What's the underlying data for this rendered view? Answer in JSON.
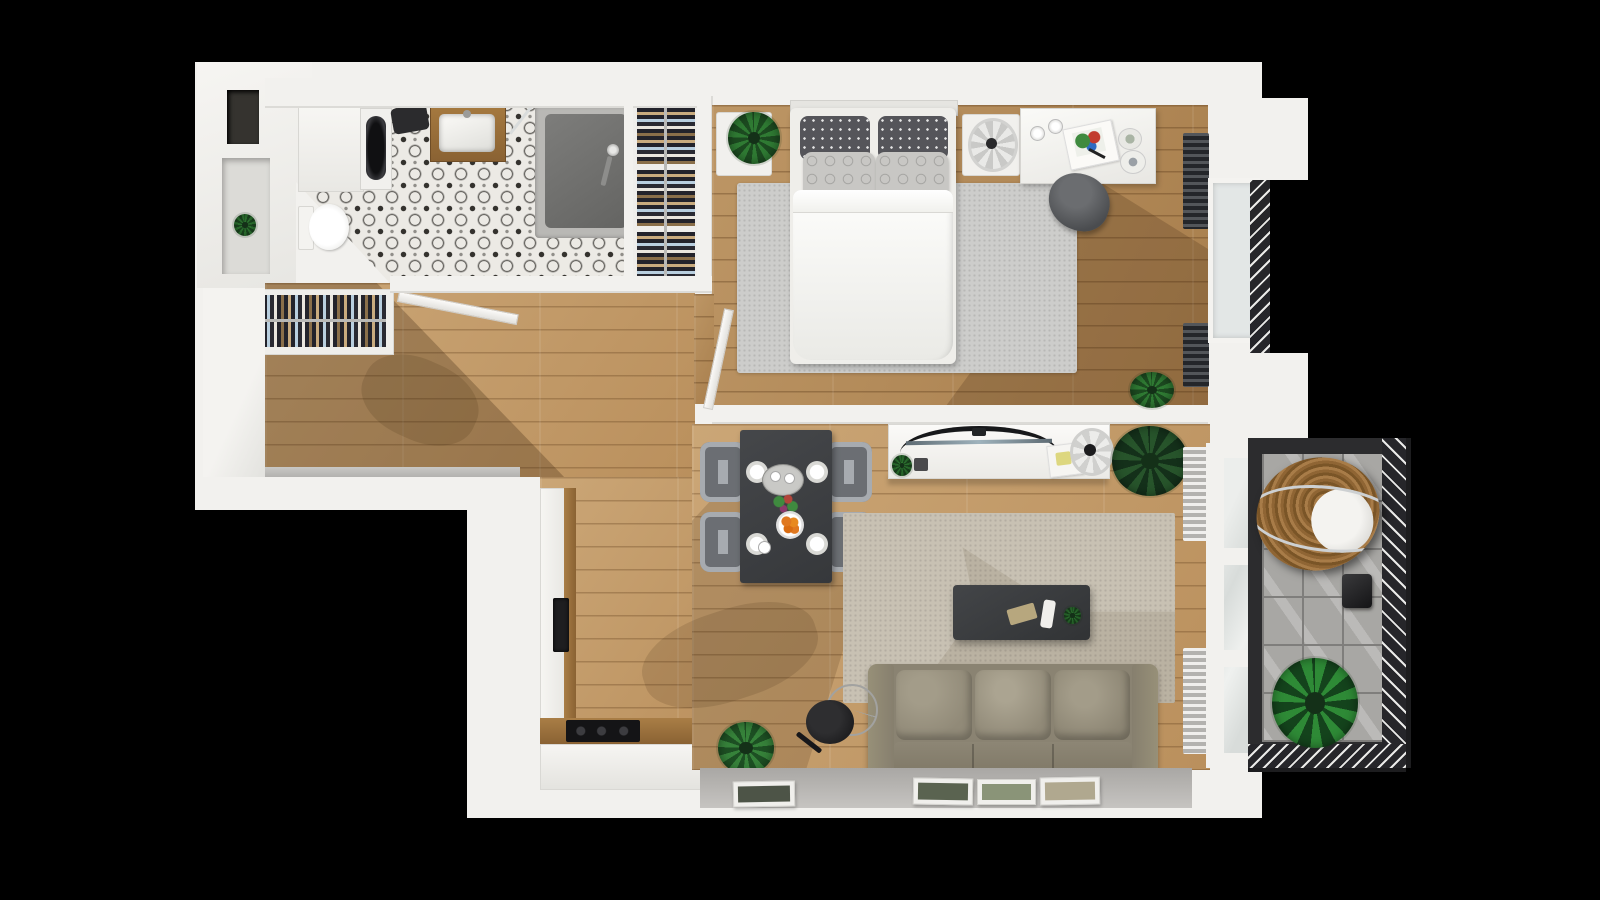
{
  "meta": {
    "title": "3D Apartment Floor Plan - Top View Render",
    "scene": "top-down 3D rendered floor plan of a one-bedroom apartment on a black background",
    "lighting": "sunlight casting diagonal shadows across wood floors"
  },
  "palette": {
    "bg": "#000000",
    "wall": "#f2f1ee",
    "walledge": "#d9d8d4",
    "wood": "#c59c67",
    "woodbed": "#b78d58",
    "tile": "#eceae5",
    "tiledark": "#34322e",
    "grayledge": "#bdbbb8",
    "ruggray": "#cccccа",
    "rugbeige": "#c8c1b3",
    "sofa": "#8a8372",
    "tabledark": "#3d3f42",
    "chairgray": "#73767b",
    "balconyframe": "#2c2c2e",
    "balconytile": "#a8a7a4",
    "rattan": "#8a6234",
    "leaf1": "#2f7a33",
    "leaf2": "#1c4a20",
    "orange": "#e07820"
  },
  "rooms": {
    "bathroom": {
      "label": "bathroom",
      "floor": "black and white patterned tile",
      "items": [
        "storage cabinets",
        "washing machine",
        "toilet",
        "wood washbasin vanity",
        "walk-in shower",
        "shower glass door"
      ]
    },
    "bedroom": {
      "label": "bedroom",
      "floor": "oak plank",
      "items": [
        "double bed with white duvet",
        "4 pillows",
        "gray rug",
        "nightstand with plant",
        "nightstand with table fan",
        "desk with magazine and cups",
        "desk chair",
        "wardrobe with hanging clothes",
        "2 dark radiators",
        "window with juliet balcony",
        "floor plant",
        "open door"
      ]
    },
    "hallway": {
      "label": "entry hallway",
      "floor": "oak plank",
      "items": [
        "open wardrobe with hanging clothes",
        "open entry door"
      ]
    },
    "kitchen": {
      "label": "kitchen",
      "floor": "oak plank",
      "items": [
        "L-shaped white counter with wood top",
        "black cooktop",
        "built-in dark appliance"
      ]
    },
    "dining": {
      "label": "dining area",
      "floor": "oak plank",
      "items": [
        "dark dining table",
        "4 gray chairs",
        "4 white place settings",
        "serving tray with cups",
        "flower bunch",
        "plate of oranges"
      ]
    },
    "living": {
      "label": "living room",
      "floor": "oak plank",
      "items": [
        "white tv console",
        "curved tv",
        "desk fan",
        "small plant",
        "large potted plant",
        "beige rug",
        "dark coffee table",
        "3-seat beige sofa",
        "black floor lamp",
        "4 leaning picture frames",
        "2 light radiators",
        "balcony window door"
      ]
    },
    "balcony": {
      "label": "balcony",
      "floor": "gray tile",
      "items": [
        "hanging rattan egg chair with white cushion",
        "dark lantern",
        "large potted plant",
        "dark metal railing with hatch balusters"
      ]
    }
  }
}
